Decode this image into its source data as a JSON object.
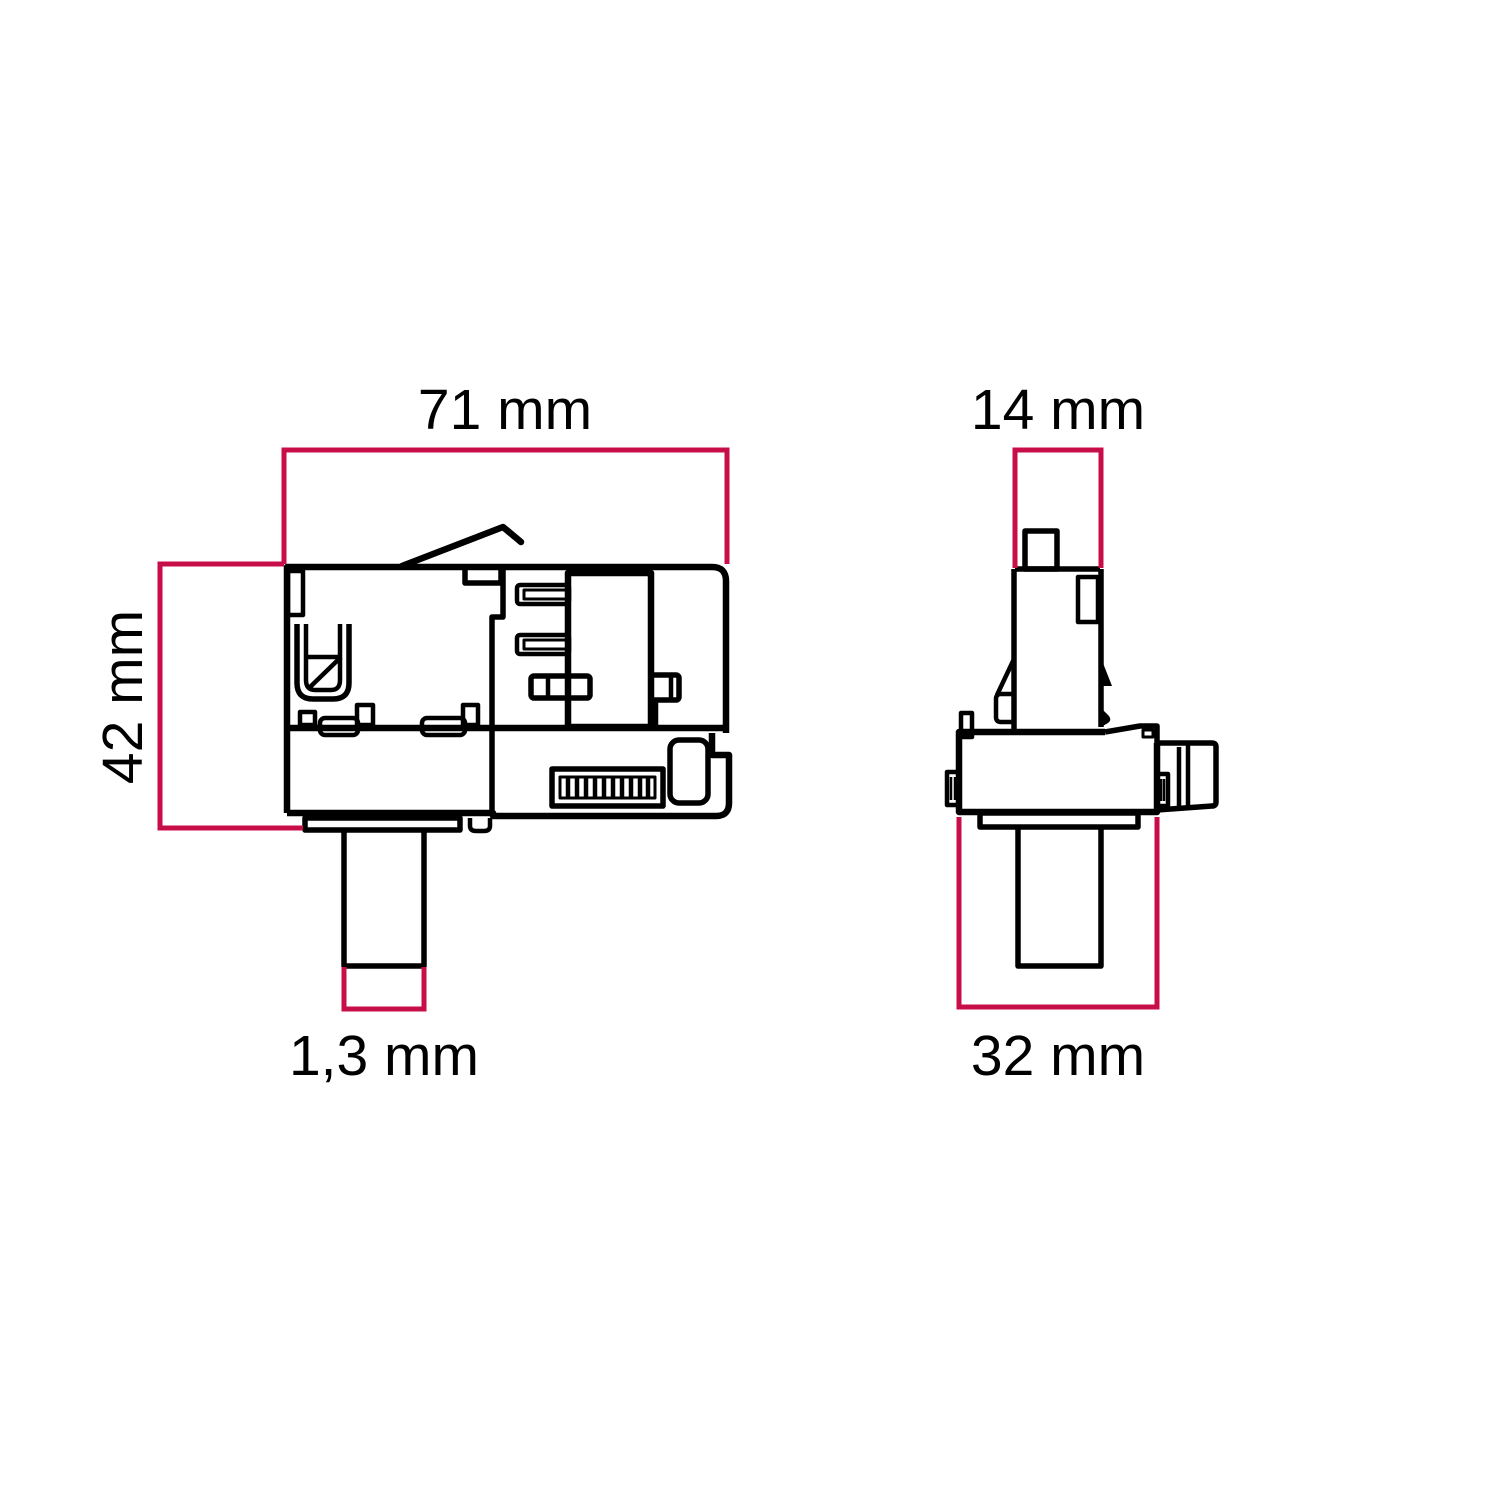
{
  "drawing": {
    "colors": {
      "outline": "#000000",
      "dimension_lines": "#c80e48",
      "background": "#ffffff"
    },
    "views": [
      {
        "id": "side-view",
        "dimensions": [
          {
            "edge": "top",
            "label": "71 mm"
          },
          {
            "edge": "left",
            "label": "42 mm"
          },
          {
            "edge": "bottom-stem",
            "label": "1,3 mm"
          }
        ]
      },
      {
        "id": "front-view",
        "dimensions": [
          {
            "edge": "top",
            "label": "14 mm"
          },
          {
            "edge": "bottom",
            "label": "32 mm"
          }
        ]
      }
    ]
  }
}
